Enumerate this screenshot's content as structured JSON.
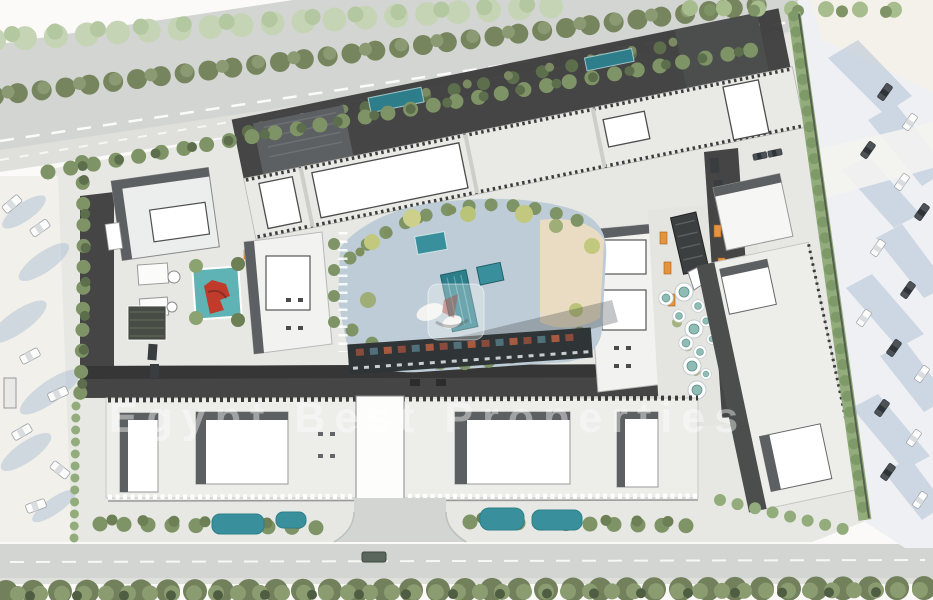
{
  "scene": {
    "title": "Residential compound master plan",
    "description": "Aerial architectural master-plan rendering: tree-lined boulevard to the north, sandy parking lots with car shadows to the west and east, long serrated residential bars, a central landscaped courtyard with swimming pools and beach deck, a market street with orange kiosks and round seating pods, southern residential row with white roof towers, gardens with ponds and a southern access road"
  },
  "watermark": {
    "text": "Egypt Best Properties"
  },
  "palette": {
    "road": "#d3d5d2",
    "sidewalk": "#dfe0dc",
    "site": "#e7e8e4",
    "pave": "#e4e5e1",
    "asphalt": "#454545",
    "asphaltDark": "#363636",
    "bldg": "#ffffff",
    "bldgLight": "#ededea",
    "roofDark": "#4b4e4d",
    "shadow": "#5d6062",
    "treePale": "#c6d4b6",
    "treeOlive": "#77855f",
    "tree": "#7f9466",
    "treeDark": "#5d6e4c",
    "hedge": "#93ac7c",
    "pool": "#2d7e8a",
    "poolLight": "#39909c",
    "courtBlue": "#bdccd6",
    "sand": "#e9dcc2",
    "parkSand": "#f2f0ea",
    "shadowBlue": "#aebfd6",
    "carDark": "#4c5257",
    "kiosk": "#e5933c",
    "playRed": "#c13b2c"
  },
  "features": [
    "north boulevard with median trees",
    "west sand parking lot",
    "east parking lot",
    "diagonal residential bar building",
    "central courtyard with pools",
    "market street with kiosks and pods",
    "south residential row with gardens",
    "south road with tree line"
  ]
}
